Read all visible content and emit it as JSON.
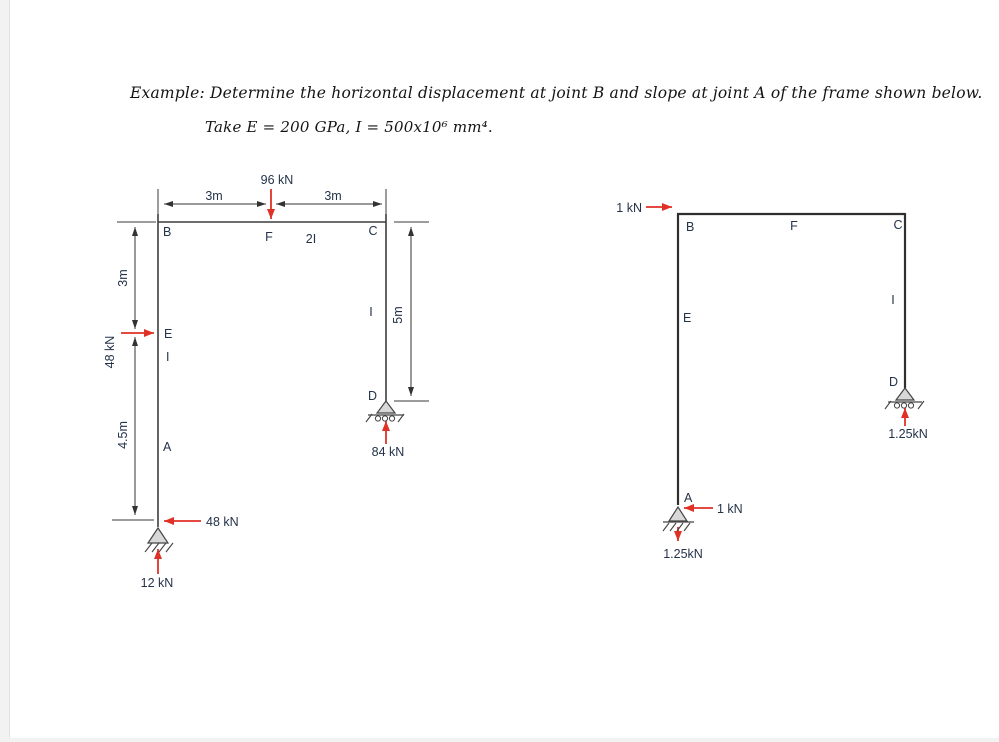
{
  "title": {
    "line1": "Example: Determine the horizontal displacement at joint B and slope at joint A of the frame shown below.",
    "line2": "Take E = 200 GPa, I = 500x10⁶ mm⁴."
  },
  "colors": {
    "force_red": "#e03127",
    "label_navy": "#243349",
    "frame_dark": "#3d3d3d"
  },
  "real_frame": {
    "joints": {
      "b": "B",
      "f": "F",
      "c": "C",
      "e": "E",
      "a": "A",
      "d": "D"
    },
    "members": {
      "beam": "2I",
      "left_column": "I",
      "right_column": "I"
    },
    "dims": {
      "top_left": "3m",
      "top_right": "3m",
      "left_upper": "3m",
      "left_lower": "4.5m",
      "right_column": "5m"
    },
    "loads": {
      "vertical_at_f": "96 kN",
      "horizontal_at_e": "48 kN"
    },
    "reactions": {
      "horizontal_at_a": "48 kN",
      "vertical_at_a": "12 kN",
      "vertical_at_d": "84 kN"
    }
  },
  "virtual_frame": {
    "joints": {
      "b": "B",
      "f": "F",
      "c": "C",
      "e": "E",
      "a": "A",
      "d": "D"
    },
    "members": {
      "right_column": "I"
    },
    "loads": {
      "horizontal_at_b": "1 kN"
    },
    "reactions": {
      "horizontal_at_a": "1 kN",
      "vertical_at_a": "1.25kN",
      "vertical_at_d": "1.25kN"
    }
  }
}
